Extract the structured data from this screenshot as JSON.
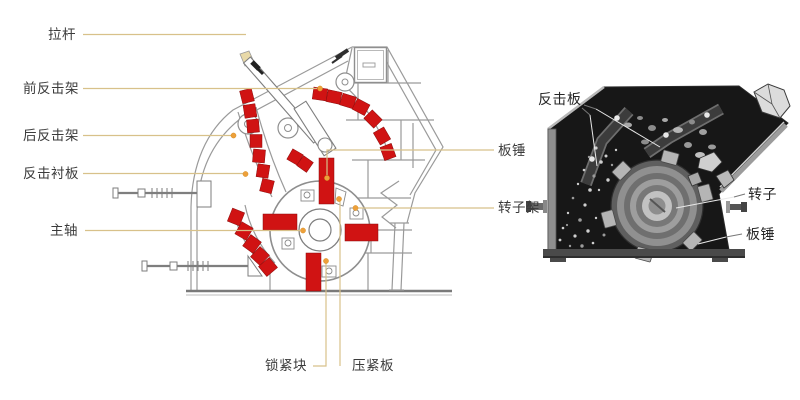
{
  "left_diagram": {
    "labels": {
      "tie_rod": "拉杆",
      "front_impact_frame": "前反击架",
      "rear_impact_frame": "后反击架",
      "impact_liner_plate": "反击衬板",
      "main_shaft": "主轴",
      "blow_bar": "板锤",
      "rotor_frame": "转子架",
      "locking_block": "锁紧块",
      "pressing_plate": "压紧板"
    },
    "colors": {
      "highlight_red": "#d01313",
      "leader_line": "#d8c18a",
      "leader_dot": "#eda03a",
      "drawing_line": "#9a9a9a",
      "label_text": "#3b3b3b"
    }
  },
  "right_photo": {
    "labels": {
      "impact_plate": "反击板",
      "rotor": "转子",
      "blow_bar": "板锤"
    },
    "colors": {
      "photo_background": "#171717",
      "metal_gray": "#8f8f8f",
      "leader_on_photo": "#e8e8e8"
    }
  }
}
